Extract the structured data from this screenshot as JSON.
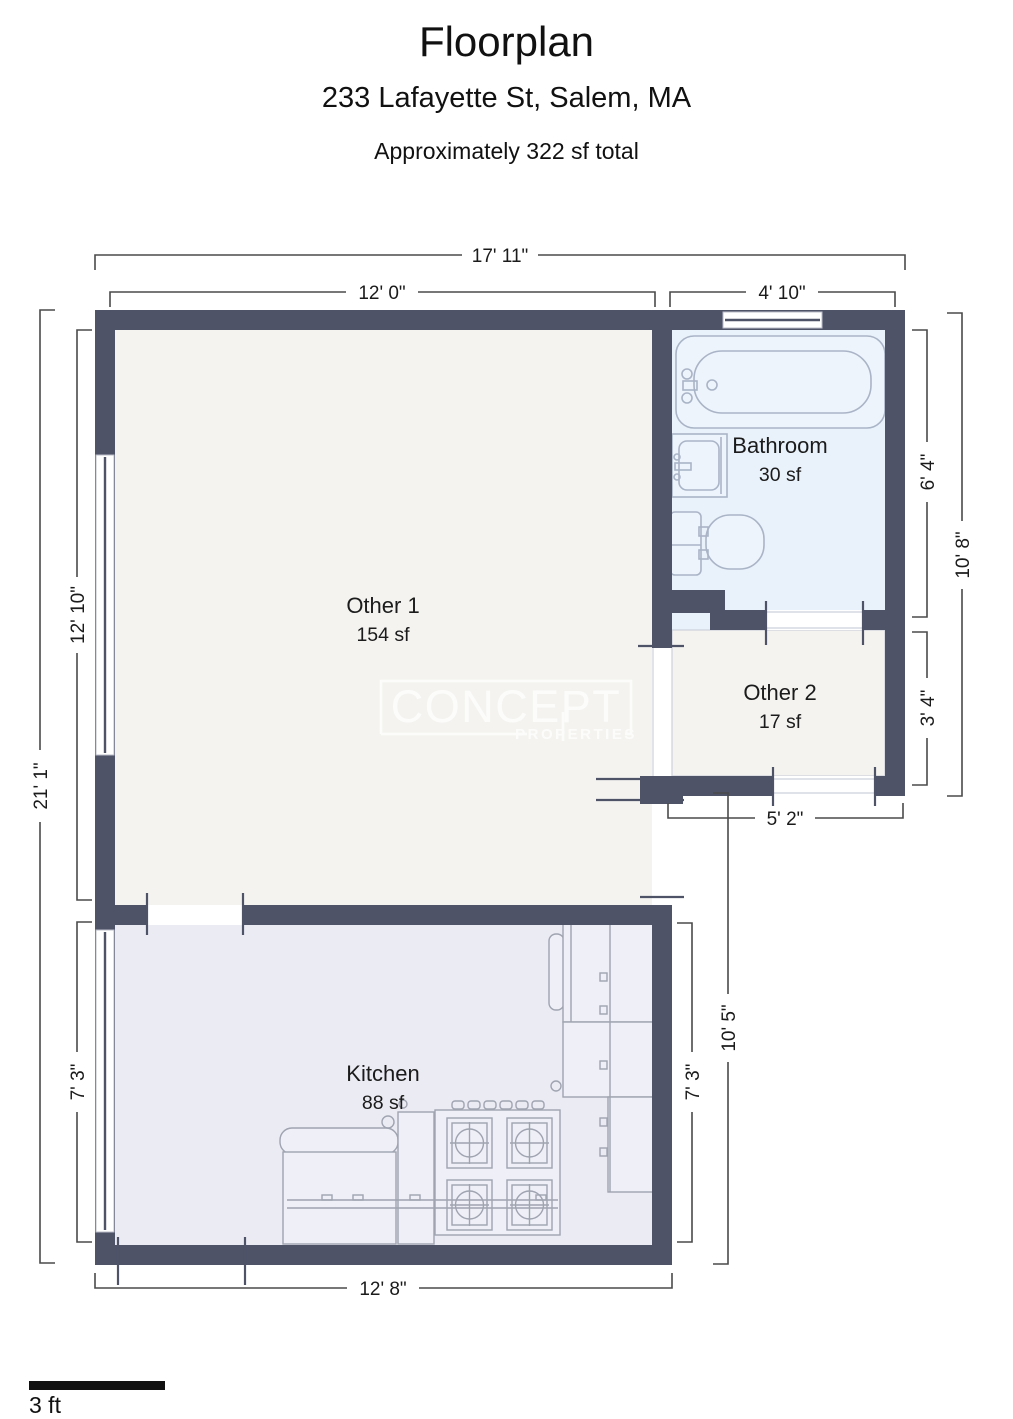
{
  "header": {
    "title": "Floorplan",
    "address": "233 Lafayette St, Salem, MA",
    "subtitle": "Approximately 322 sf total"
  },
  "rooms": {
    "other1": {
      "name": "Other 1",
      "area": "154 sf"
    },
    "bathroom": {
      "name": "Bathroom",
      "area": "30 sf"
    },
    "other2": {
      "name": "Other 2",
      "area": "17 sf"
    },
    "kitchen": {
      "name": "Kitchen",
      "area": "88 sf"
    }
  },
  "dimensions": {
    "overall_width": "17' 11\"",
    "other1_width": "12' 0\"",
    "bathroom_width": "4' 10\"",
    "overall_height": "21' 1\"",
    "other1_height": "12' 10\"",
    "kitchen_height_left": "7' 3\"",
    "bathroom_height": "6' 4\"",
    "right_upper_height": "10' 8\"",
    "other2_height": "3' 4\"",
    "other2_width": "5' 2\"",
    "kitchen_height_right": "7' 3\"",
    "kitchen_right_outer_height": "10' 5\"",
    "kitchen_width": "12' 8\""
  },
  "watermark": {
    "line1": "CONCEPT",
    "line2": "PROPERTIES"
  },
  "scale_bar": {
    "label": "3 ft"
  },
  "colors": {
    "wall": "#4e5368",
    "floor_other": "#f4f3f0",
    "floor_bath": "#e9f1fa",
    "floor_kitchen": "#ebebf4",
    "fixture_stroke": "#a9b4c6",
    "fixture_fill": "#eef4fc",
    "kitchen_stroke": "#9fa4b0",
    "kitchen_fill": "#efeff7",
    "dim": "#4a4a4a",
    "text": "#1b1b1b",
    "watermark": "#ffffff",
    "guide": "#ccd0da"
  }
}
